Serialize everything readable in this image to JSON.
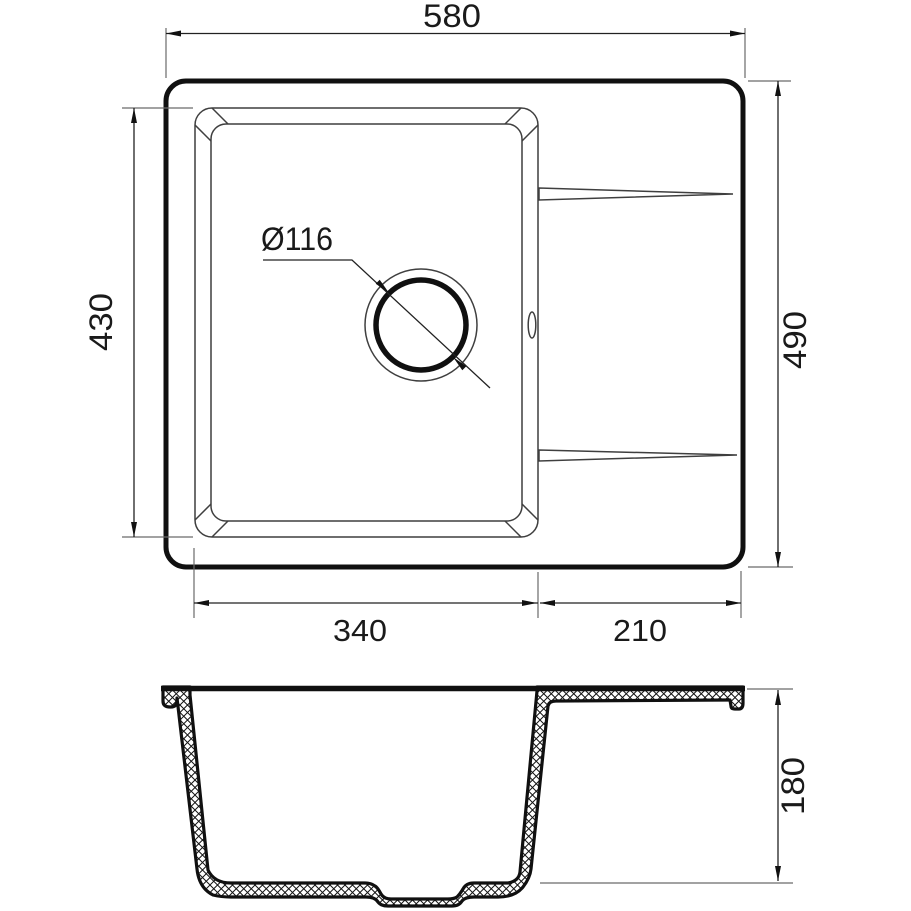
{
  "dims": {
    "overall_width": "580",
    "bowl_length": "430",
    "overall_depth": "490",
    "bowl_width": "340",
    "drainboard_width": "210",
    "height": "180",
    "drain_diameter": "Ø116"
  },
  "colors": {
    "line": "#101010",
    "thin_line": "#3f3f3f",
    "extension_line": "#6a6a6a",
    "background": "#ffffff"
  }
}
